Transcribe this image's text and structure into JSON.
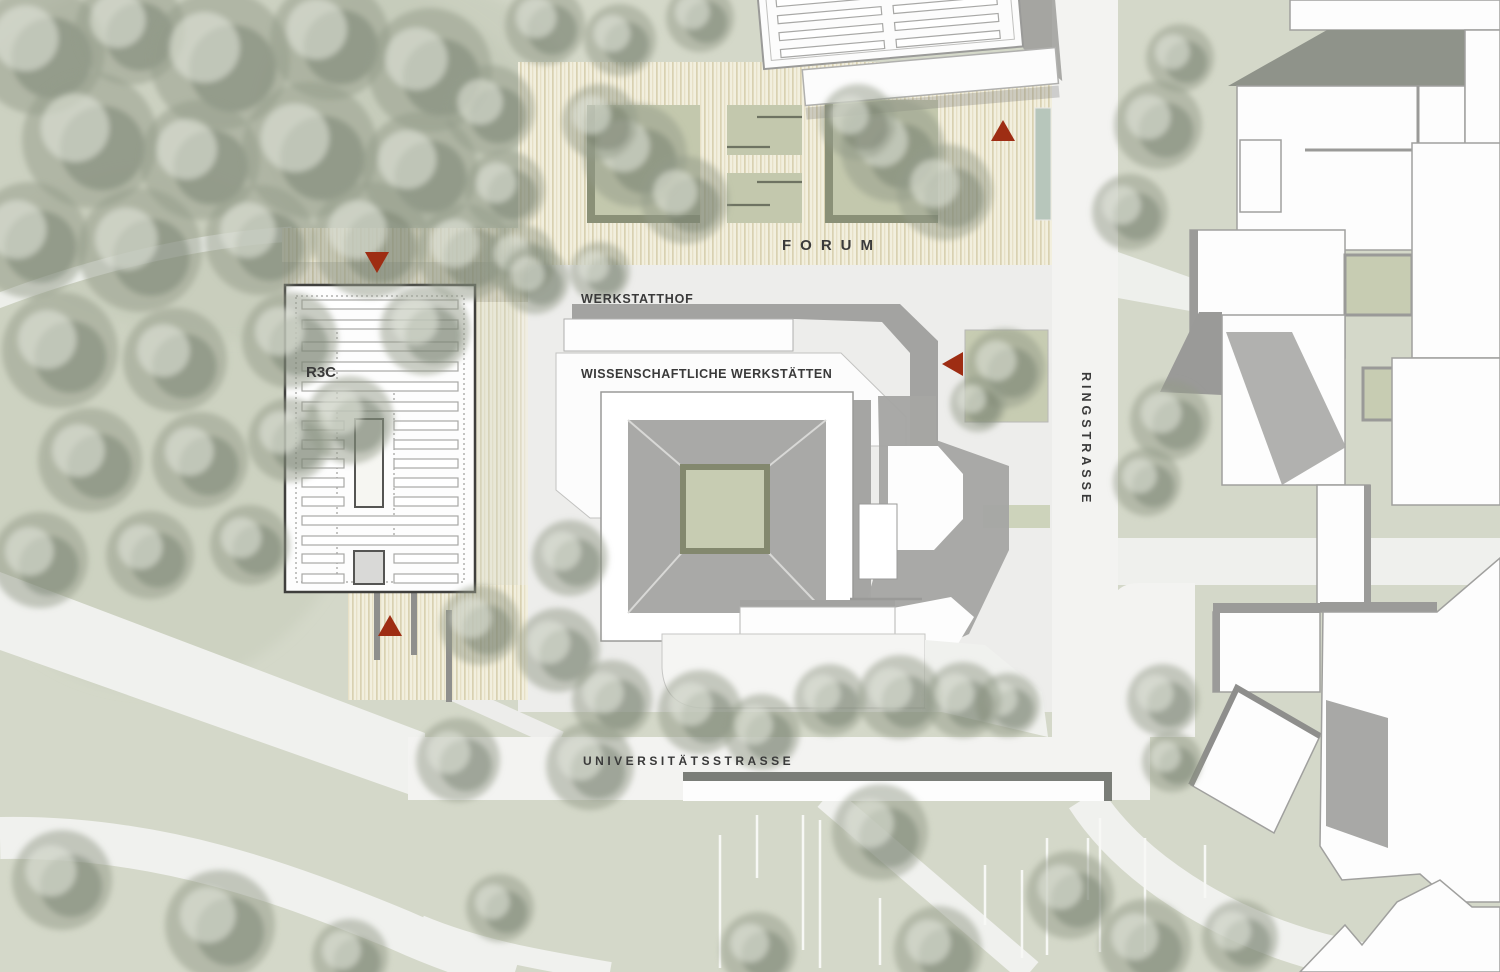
{
  "labels": {
    "forum": "FORUM",
    "werkstatthof": "WERKSTATTHOF",
    "wissenschaftliche_werkstaetten": "WISSENSCHAFTLICHE WERKSTÄTTEN",
    "r3c": "R3C",
    "ringstrasse": "RINGSTRASSE",
    "universitaetsstrasse": "UNIVERSITÄTSSTRASSE"
  },
  "markers": [
    {
      "name": "entrance-marker-forum-north",
      "direction": "down",
      "x": 377,
      "y": 262
    },
    {
      "name": "entrance-marker-forum-east",
      "direction": "up",
      "x": 1003,
      "y": 130
    },
    {
      "name": "entrance-marker-werkstaetten-east",
      "direction": "left",
      "x": 953,
      "y": 364
    },
    {
      "name": "entrance-marker-r3c-south",
      "direction": "up",
      "x": 390,
      "y": 625
    }
  ],
  "colors": {
    "accent_red": "#9e2d13",
    "park_green": "#d4d8c9",
    "deck_cream": "#f2efde",
    "courtyard_green": "#c7ccb2",
    "roof_gray": "#a9a9a7",
    "building_white": "#ffffff",
    "street_white": "#f3f3f1",
    "water_teal": "#b7c6bb",
    "label_text": "#3a3a3a"
  }
}
